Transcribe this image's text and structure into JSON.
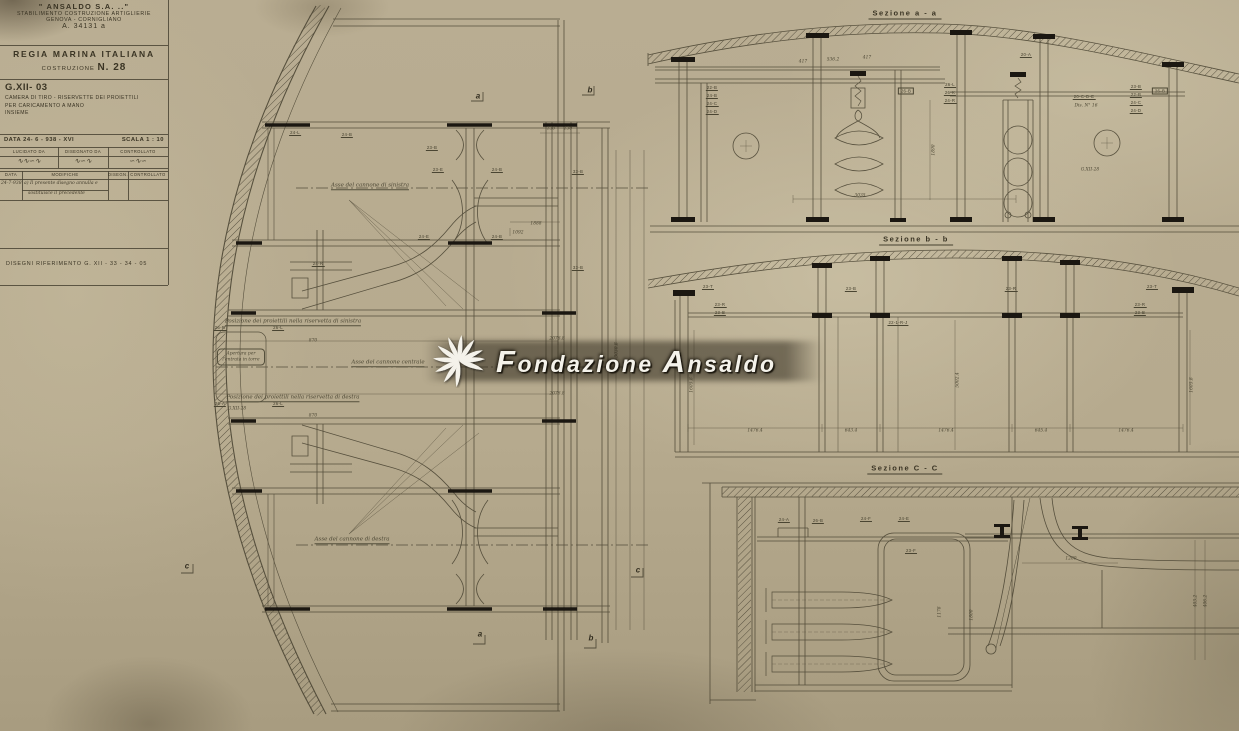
{
  "colors": {
    "paper": "#b6aa8f",
    "ink": "#45402e",
    "black": "#1b1711",
    "watermark_text": "#f4f2ea"
  },
  "title_block": {
    "company_name": "\" ANSALDO  S.A. ..\"",
    "company_sub1": "STABILIMENTO COSTRUZIONE ARTIGLIERIE",
    "company_sub2": "GENOVA - CORNIGLIANO",
    "reg_number": "A. 34131 a",
    "org": "REGIA MARINA ITALIANA",
    "costruzione_label": "COSTRUZIONE",
    "costruzione_num": "N. 28",
    "drawing_code": "G.XII- 03",
    "subject_line1": "CAMERA DI TIRO - RISERVETTE DEI PROIETTILI",
    "subject_line2": "PER CARICAMENTO A MANO",
    "subject_line3": "INSIEME",
    "date_label": "DATA  24- 6 - 938 - XVI",
    "scale_label": "SCALA  1 : 10",
    "sign_header_1": "LUCIDATO DA",
    "sign_header_2": "DISEGNATO DA",
    "sign_header_3": "CONTROLLATO",
    "signature_1": "∿∿∽∿",
    "signature_2": "∿∽∿",
    "signature_3": "∽∿∽",
    "mod_header_data": "DATA",
    "mod_header_modifiche": "MODIFICHE",
    "mod_header_disegn": "DISEGN.",
    "mod_header_controllato": "CONTROLLATO",
    "mod_date": "24-7-938",
    "mod_note_line1": "a) Il presente disegno annulla e",
    "mod_note_line2": "sostituisce il precedente",
    "riferimento": "DISEGNI RIFERIMENTO    G. XII - 33 - 34 - 05"
  },
  "watermark": {
    "word1_cap": "F",
    "word1_rest": "ondazione",
    "word2_cap": "A",
    "word2_rest": "nsaldo"
  },
  "annotations": [
    {
      "t": "Sezione  a - a",
      "x": 905,
      "y": 14,
      "c": "sec-title"
    },
    {
      "t": "Sezione  b - b",
      "x": 916,
      "y": 240,
      "c": "sec-title"
    },
    {
      "t": "Sezione  C - C",
      "x": 905,
      "y": 469,
      "c": "sec-title"
    },
    {
      "t": "Asse del cannone di sinistra",
      "x": 370,
      "y": 186,
      "c": "hand-u"
    },
    {
      "t": "Asse del cannone centrale",
      "x": 388,
      "y": 363,
      "c": "hand-u"
    },
    {
      "t": "Asse del cannone di destra",
      "x": 352,
      "y": 540,
      "c": "hand-u"
    },
    {
      "t": "Posizione dei proiettili nella riservetta di sinistra",
      "x": 293,
      "y": 322,
      "c": "hand-u"
    },
    {
      "t": "Posizione dei proiettili nella riservetta di destra",
      "x": 293,
      "y": 398,
      "c": "hand-u"
    },
    {
      "t": "Apertura per l'entrata in torre",
      "x": 241,
      "y": 357,
      "c": "handbox"
    },
    {
      "t": "G.XII-28",
      "x": 237,
      "y": 409,
      "c": "dim"
    },
    {
      "t": "a",
      "x": 478,
      "y": 96,
      "c": "marker"
    },
    {
      "t": "b",
      "x": 590,
      "y": 90,
      "c": "marker"
    },
    {
      "t": "a",
      "x": 480,
      "y": 634,
      "c": "marker"
    },
    {
      "t": "b",
      "x": 591,
      "y": 638,
      "c": "marker"
    },
    {
      "t": "c",
      "x": 187,
      "y": 566,
      "c": "marker"
    },
    {
      "t": "c",
      "x": 638,
      "y": 570,
      "c": "marker"
    },
    {
      "t": "1888",
      "x": 536,
      "y": 224,
      "c": "dim"
    },
    {
      "t": "1092",
      "x": 518,
      "y": 233,
      "c": "dim"
    },
    {
      "t": "870",
      "x": 313,
      "y": 341,
      "c": "dim"
    },
    {
      "t": "2076.8",
      "x": 557,
      "y": 339,
      "c": "dim"
    },
    {
      "t": "2076.8",
      "x": 557,
      "y": 394,
      "c": "dim"
    },
    {
      "t": "870",
      "x": 313,
      "y": 416,
      "c": "dim"
    },
    {
      "t": "130",
      "x": 551,
      "y": 129,
      "c": "dim"
    },
    {
      "t": "130",
      "x": 568,
      "y": 129,
      "c": "dim"
    },
    {
      "t": "3030.8",
      "x": 617,
      "y": 350,
      "c": "dimv"
    },
    {
      "t": "24-L",
      "x": 295,
      "y": 133,
      "c": "plab"
    },
    {
      "t": "24-B",
      "x": 347,
      "y": 135,
      "c": "plab"
    },
    {
      "t": "23-B",
      "x": 432,
      "y": 148,
      "c": "plab"
    },
    {
      "t": "23-E",
      "x": 438,
      "y": 170,
      "c": "plab"
    },
    {
      "t": "24-B",
      "x": 497,
      "y": 170,
      "c": "plab"
    },
    {
      "t": "24-E",
      "x": 424,
      "y": 237,
      "c": "plab"
    },
    {
      "t": "24-B",
      "x": 497,
      "y": 237,
      "c": "plab"
    },
    {
      "t": "33-B",
      "x": 578,
      "y": 172,
      "c": "plab"
    },
    {
      "t": "33-B",
      "x": 578,
      "y": 268,
      "c": "plab"
    },
    {
      "t": "24-R",
      "x": 318,
      "y": 264,
      "c": "plab"
    },
    {
      "t": "26-R",
      "x": 220,
      "y": 328,
      "c": "plab"
    },
    {
      "t": "26-L",
      "x": 278,
      "y": 328,
      "c": "plab"
    },
    {
      "t": "26-A",
      "x": 220,
      "y": 404,
      "c": "plab"
    },
    {
      "t": "26-L",
      "x": 278,
      "y": 404,
      "c": "plab"
    },
    {
      "t": "22-B",
      "x": 712,
      "y": 88,
      "c": "plab"
    },
    {
      "t": "24-B",
      "x": 712,
      "y": 96,
      "c": "plab"
    },
    {
      "t": "24-C",
      "x": 712,
      "y": 104,
      "c": "plab"
    },
    {
      "t": "24-D",
      "x": 712,
      "y": 112,
      "c": "plab"
    },
    {
      "t": "26-B",
      "x": 906,
      "y": 91,
      "c": "pbox"
    },
    {
      "t": "26-L",
      "x": 950,
      "y": 85,
      "c": "plab"
    },
    {
      "t": "26-K",
      "x": 950,
      "y": 93,
      "c": "plab"
    },
    {
      "t": "24-R",
      "x": 950,
      "y": 101,
      "c": "plab"
    },
    {
      "t": "20-A",
      "x": 1026,
      "y": 55,
      "c": "plab"
    },
    {
      "t": "20-C-D-E",
      "x": 1084,
      "y": 97,
      "c": "plab"
    },
    {
      "t": "Dis. N° 16",
      "x": 1086,
      "y": 106,
      "c": "dim"
    },
    {
      "t": "G.XII-28",
      "x": 1090,
      "y": 170,
      "c": "dim"
    },
    {
      "t": "23-B",
      "x": 1136,
      "y": 87,
      "c": "plab"
    },
    {
      "t": "22-B",
      "x": 1136,
      "y": 95,
      "c": "plab"
    },
    {
      "t": "24-C",
      "x": 1136,
      "y": 103,
      "c": "plab"
    },
    {
      "t": "24-D",
      "x": 1136,
      "y": 111,
      "c": "plab"
    },
    {
      "t": "26-B",
      "x": 1160,
      "y": 91,
      "c": "pbox"
    },
    {
      "t": "417",
      "x": 803,
      "y": 62,
      "c": "dim"
    },
    {
      "t": "536.2",
      "x": 833,
      "y": 60,
      "c": "dim"
    },
    {
      "t": "417",
      "x": 867,
      "y": 58,
      "c": "dim"
    },
    {
      "t": "3035",
      "x": 860,
      "y": 196,
      "c": "dim"
    },
    {
      "t": "1890",
      "x": 934,
      "y": 150,
      "c": "dimv"
    },
    {
      "t": "23-T",
      "x": 708,
      "y": 287,
      "c": "plab"
    },
    {
      "t": "23-R",
      "x": 720,
      "y": 305,
      "c": "plab"
    },
    {
      "t": "23-B",
      "x": 720,
      "y": 313,
      "c": "plab"
    },
    {
      "t": "23-B",
      "x": 851,
      "y": 289,
      "c": "plab"
    },
    {
      "t": "23-R",
      "x": 1011,
      "y": 289,
      "c": "plab"
    },
    {
      "t": "23-T",
      "x": 1152,
      "y": 287,
      "c": "plab"
    },
    {
      "t": "23-R",
      "x": 1140,
      "y": 305,
      "c": "plab"
    },
    {
      "t": "23-B",
      "x": 1140,
      "y": 313,
      "c": "plab"
    },
    {
      "t": "22-1-R-J",
      "x": 898,
      "y": 323,
      "c": "plab"
    },
    {
      "t": "1476.4",
      "x": 755,
      "y": 431,
      "c": "dim"
    },
    {
      "t": "643.4",
      "x": 851,
      "y": 431,
      "c": "dim"
    },
    {
      "t": "1476.4",
      "x": 946,
      "y": 431,
      "c": "dim"
    },
    {
      "t": "645.4",
      "x": 1041,
      "y": 431,
      "c": "dim"
    },
    {
      "t": "1476.4",
      "x": 1126,
      "y": 431,
      "c": "dim"
    },
    {
      "t": "1605.8",
      "x": 692,
      "y": 385,
      "c": "dimv"
    },
    {
      "t": "5002.4",
      "x": 958,
      "y": 380,
      "c": "dimv"
    },
    {
      "t": "1605.8",
      "x": 1192,
      "y": 385,
      "c": "dimv"
    },
    {
      "t": "24-A",
      "x": 784,
      "y": 520,
      "c": "plab"
    },
    {
      "t": "26-B",
      "x": 818,
      "y": 521,
      "c": "plab"
    },
    {
      "t": "24-F",
      "x": 866,
      "y": 519,
      "c": "plab"
    },
    {
      "t": "24-E",
      "x": 904,
      "y": 519,
      "c": "plab"
    },
    {
      "t": "23-F",
      "x": 911,
      "y": 551,
      "c": "plab"
    },
    {
      "t": "1200",
      "x": 1071,
      "y": 559,
      "c": "dim"
    },
    {
      "t": "1178",
      "x": 940,
      "y": 612,
      "c": "dimv"
    },
    {
      "t": "1800",
      "x": 972,
      "y": 615,
      "c": "dimv"
    },
    {
      "t": "403.2",
      "x": 1196,
      "y": 601,
      "c": "dimv"
    },
    {
      "t": "406.2",
      "x": 1206,
      "y": 601,
      "c": "dimv"
    }
  ]
}
